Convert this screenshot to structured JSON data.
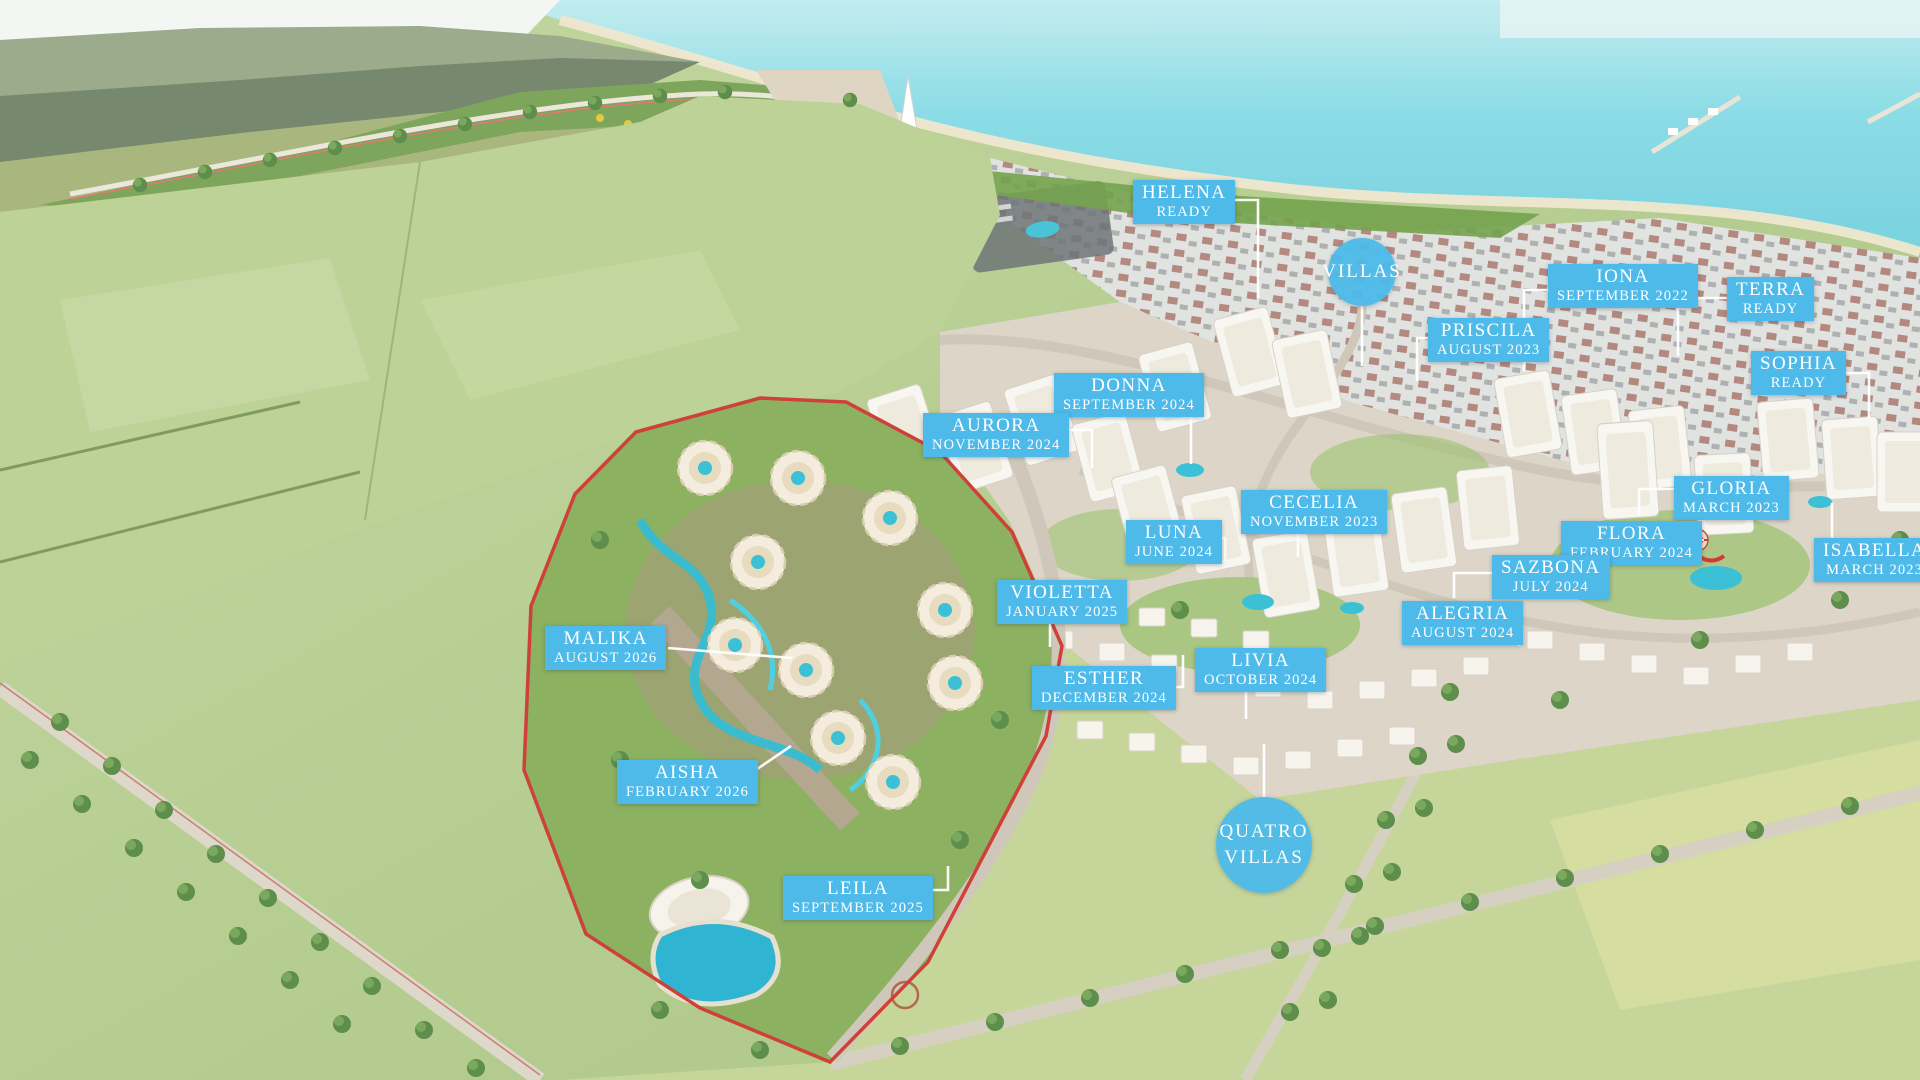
{
  "colors": {
    "label_blue": "#4dbae9",
    "label_text": "#ffffff",
    "leader_white": "#ffffff",
    "site_boundary_red": "#cf4038",
    "sea_turquoise": "#7fd2de",
    "pool_blue": "#3cc0d6",
    "field_green": "#b9d094"
  },
  "phases": [
    {
      "name": "HELENA",
      "status": "READY",
      "x": 1133,
      "y": 180,
      "leader": [
        [
          1222,
          200
        ],
        [
          1258,
          200
        ],
        [
          1258,
          298
        ]
      ]
    },
    {
      "name": "IONA",
      "status": "SEPTEMBER 2022",
      "x": 1548,
      "y": 264,
      "leader": [
        [
          1548,
          290
        ],
        [
          1524,
          290
        ],
        [
          1524,
          371
        ]
      ]
    },
    {
      "name": "TERRA",
      "status": "READY",
      "x": 1727,
      "y": 277,
      "leader": [
        [
          1727,
          298
        ],
        [
          1678,
          298
        ],
        [
          1678,
          356
        ]
      ]
    },
    {
      "name": "PRISCILA",
      "status": "AUGUST 2023",
      "x": 1428,
      "y": 318,
      "leader": [
        [
          1428,
          338
        ],
        [
          1417,
          338
        ],
        [
          1417,
          381
        ]
      ]
    },
    {
      "name": "SOPHIA",
      "status": "READY",
      "x": 1751,
      "y": 351,
      "leader": [
        [
          1841,
          373
        ],
        [
          1869,
          373
        ],
        [
          1869,
          418
        ]
      ]
    },
    {
      "name": "DONNA",
      "status": "SEPTEMBER 2024",
      "x": 1054,
      "y": 373,
      "leader": [
        [
          1180,
          390
        ],
        [
          1191,
          390
        ],
        [
          1191,
          464
        ]
      ]
    },
    {
      "name": "AURORA",
      "status": "NOVEMBER 2024",
      "x": 923,
      "y": 413,
      "leader": [
        [
          1050,
          430
        ],
        [
          1092,
          430
        ],
        [
          1092,
          468
        ]
      ]
    },
    {
      "name": "CECELIA",
      "status": "NOVEMBER 2023",
      "x": 1241,
      "y": 490,
      "leader": [
        [
          1298,
          528
        ],
        [
          1298,
          557
        ]
      ]
    },
    {
      "name": "LUNA",
      "status": "JUNE 2024",
      "x": 1126,
      "y": 520,
      "leader": [
        [
          1205,
          538
        ],
        [
          1225,
          538
        ],
        [
          1225,
          561
        ]
      ]
    },
    {
      "name": "GLORIA",
      "status": "MARCH 2023",
      "x": 1674,
      "y": 476,
      "leader": [
        [
          1674,
          489
        ],
        [
          1639,
          489
        ],
        [
          1639,
          515
        ]
      ]
    },
    {
      "name": "FLORA",
      "status": "FEBRUARY 2024",
      "x": 1561,
      "y": 521,
      "leader": [
        [
          1682,
          540
        ],
        [
          1704,
          540
        ]
      ]
    },
    {
      "name": "ISABELLA",
      "status": "MARCH 2023",
      "x": 1814,
      "y": 538,
      "leader": [
        [
          1832,
          538
        ],
        [
          1832,
          503
        ]
      ]
    },
    {
      "name": "SAZBONA",
      "status": "JULY 2024",
      "x": 1492,
      "y": 555,
      "leader": [
        [
          1492,
          573
        ],
        [
          1454,
          573
        ],
        [
          1454,
          598
        ]
      ]
    },
    {
      "name": "ALEGRIA",
      "status": "AUGUST 2024",
      "x": 1402,
      "y": 601,
      "leader": [
        [
          1500,
          620
        ],
        [
          1519,
          620
        ],
        [
          1519,
          646
        ]
      ]
    },
    {
      "name": "VIOLETTA",
      "status": "JANUARY 2025",
      "x": 997,
      "y": 580,
      "leader": [
        [
          1050,
          618
        ],
        [
          1050,
          647
        ]
      ]
    },
    {
      "name": "ESTHER",
      "status": "DECEMBER 2024",
      "x": 1032,
      "y": 666,
      "leader": [
        [
          1157,
          687
        ],
        [
          1183,
          687
        ],
        [
          1183,
          655
        ]
      ]
    },
    {
      "name": "LIVIA",
      "status": "OCTOBER 2024",
      "x": 1195,
      "y": 648,
      "leader": [
        [
          1246,
          685
        ],
        [
          1246,
          719
        ]
      ]
    },
    {
      "name": "MALIKA",
      "status": "AUGUST 2026",
      "x": 545,
      "y": 626,
      "leader": [
        [
          668,
          648
        ],
        [
          792,
          658
        ]
      ]
    },
    {
      "name": "AISHA",
      "status": "FEBRUARY 2026",
      "x": 617,
      "y": 760,
      "leader": [
        [
          744,
          778
        ],
        [
          791,
          746
        ]
      ]
    },
    {
      "name": "LEILA",
      "status": "SEPTEMBER 2025",
      "x": 783,
      "y": 876,
      "leader": [
        [
          898,
          890
        ],
        [
          948,
          890
        ],
        [
          948,
          866
        ]
      ]
    }
  ],
  "circles": [
    {
      "id": "villas",
      "lines": [
        "VILLAS"
      ],
      "cx": 1362,
      "cy": 272,
      "r": 34,
      "leader": [
        [
          1362,
          306
        ],
        [
          1362,
          366
        ]
      ]
    },
    {
      "id": "quatro-villas",
      "lines": [
        "QUATRO",
        "VILLAS"
      ],
      "cx": 1264,
      "cy": 845,
      "r": 48,
      "leader": [
        [
          1264,
          797
        ],
        [
          1264,
          744
        ]
      ]
    }
  ]
}
